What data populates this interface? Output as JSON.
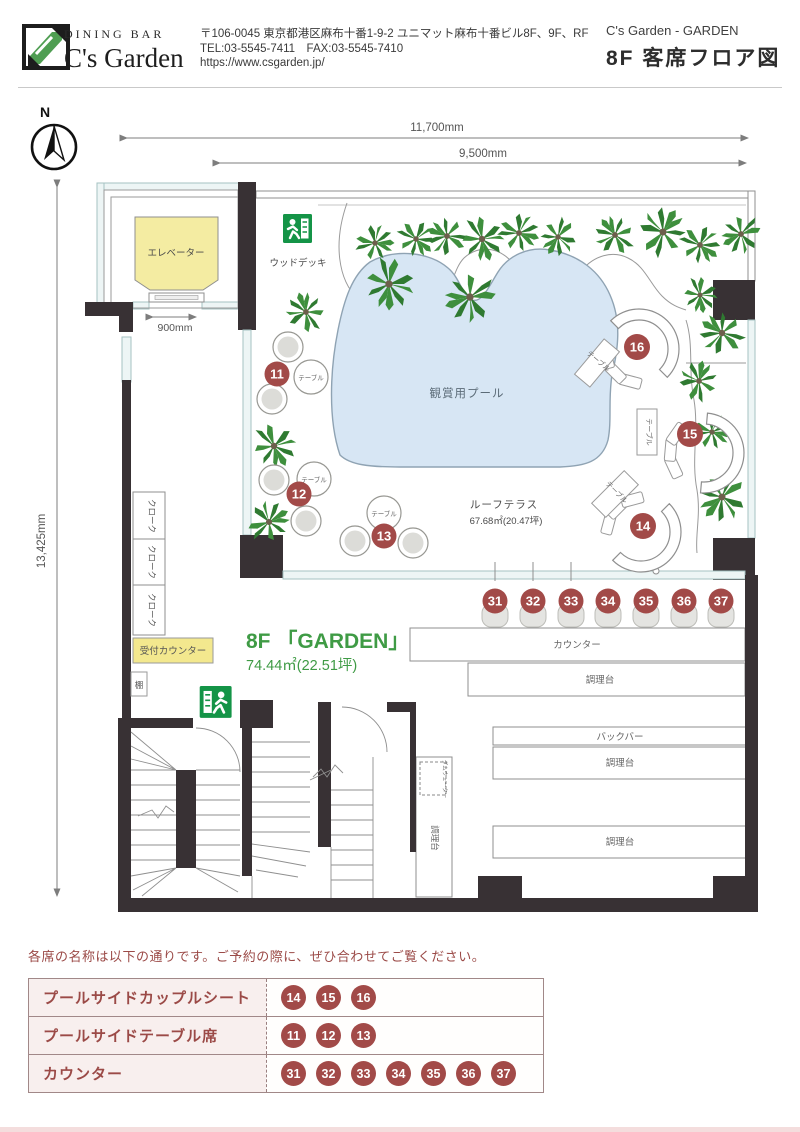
{
  "header": {
    "brand_top": "DINING BAR",
    "brand_name": "C's Garden",
    "postal_address": "〒106-0045  東京都港区麻布十番1-9-2 ユニマット麻布十番ビル8F、9F、RF",
    "tel_fax": "TEL:03-5545-7411　FAX:03-5545-7410",
    "url": "https://www.csgarden.jp/",
    "doc_title_en": "C's Garden - GARDEN",
    "doc_title_jp": "8F 客席フロア図"
  },
  "compass": {
    "north_label": "N"
  },
  "dimensions": {
    "width_total": "11,700mm",
    "width_terrace": "9,500mm",
    "height_total": "13,425mm",
    "elevator_door": "900mm"
  },
  "floor": {
    "elevator": "エレベーター",
    "wood_deck": "ウッドデッキ",
    "pool": "観賞用プール",
    "terrace_name": "ルーフテラス",
    "terrace_area": "67.68㎡(20.47坪)",
    "garden_name": "8F 「GARDEN」",
    "garden_area": "74.44㎡(22.51坪)",
    "counter": "カウンター",
    "prep": "調理台",
    "back_bar": "バックバー",
    "cloak": "クローク",
    "reception": "受付カウンター",
    "shelf": "棚",
    "table_label": "テーブル",
    "dumbwaiter": "ダムウェーター"
  },
  "seats": {
    "table": [
      "11",
      "12",
      "13"
    ],
    "couple": [
      "14",
      "15",
      "16"
    ],
    "counter": [
      "31",
      "32",
      "33",
      "34",
      "35",
      "36",
      "37"
    ]
  },
  "legend": {
    "note": "各席の名称は以下の通りです。ご予約の際に、ぜひ合わせてご覧ください。",
    "rows": [
      {
        "label": "プールサイドカップルシート",
        "seats": [
          "14",
          "15",
          "16"
        ]
      },
      {
        "label": "プールサイドテーブル席",
        "seats": [
          "11",
          "12",
          "13"
        ]
      },
      {
        "label": "カウンター",
        "seats": [
          "31",
          "32",
          "33",
          "34",
          "35",
          "36",
          "37"
        ]
      }
    ]
  },
  "colors": {
    "badge": "#a24a48",
    "accent_green": "#3f9b45",
    "exit_green": "#149447",
    "pool_blue": "#d7e6f4",
    "elevator_yellow": "#f4eca2",
    "reception_yellow": "#f3e88e",
    "wall_dark": "#383134",
    "legend_red": "#9b4a47",
    "legend_row_bg": "#f8efee"
  }
}
